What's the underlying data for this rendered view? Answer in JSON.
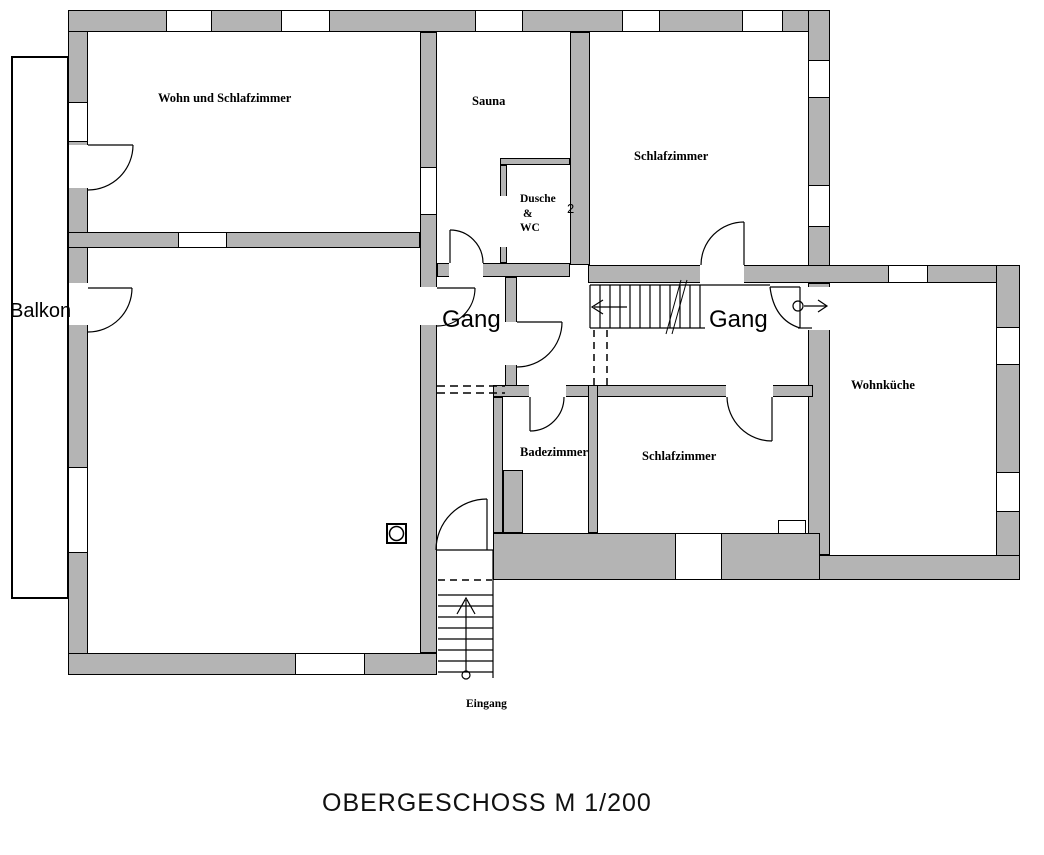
{
  "title": "OBERGESCHOSS M 1/200",
  "rooms": {
    "wohn_schlafzimmer": {
      "label": "Wohn und Schlafzimmer"
    },
    "sauna": {
      "label": "Sauna"
    },
    "dusche_wc": {
      "line1": "Dusche",
      "line2": "&",
      "line3": "WC"
    },
    "schlafzimmer_top": {
      "label": "Schlafzimmer"
    },
    "gang_left": {
      "label": "Gang"
    },
    "gang_center": {
      "label": "Gang"
    },
    "wohnkueche": {
      "label": "Wohnküche"
    },
    "badezimmer": {
      "label": "Badezimmer"
    },
    "schlafzimmer_bottom": {
      "label": "Schlafzimmer"
    },
    "balkon": {
      "label": "Balkon"
    },
    "eingang": {
      "label": "Eingang"
    }
  },
  "annotations": {
    "stair_number": "2"
  },
  "colors": {
    "wall": "#b4b4b4",
    "line": "#000000",
    "background": "#ffffff"
  }
}
